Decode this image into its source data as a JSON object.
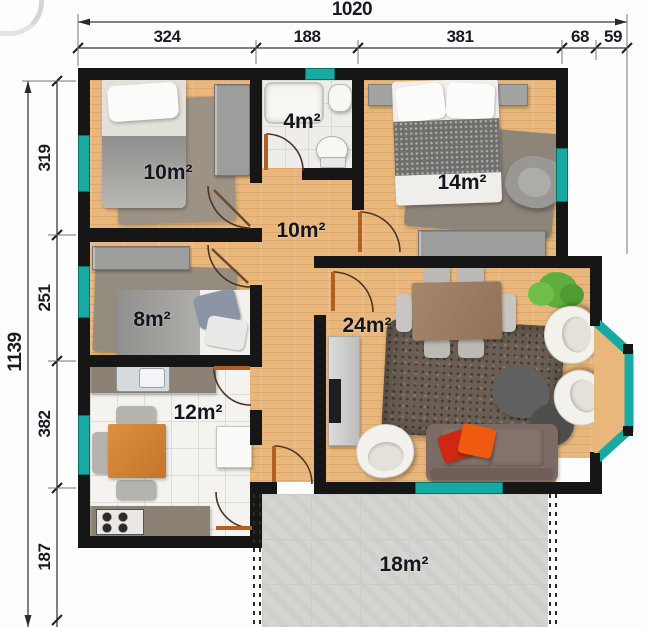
{
  "plan_title": "apartment-floor-plan",
  "dimensions": {
    "top": {
      "total": "1020",
      "segments": [
        "324",
        "188",
        "381",
        "68",
        "59"
      ]
    },
    "left": {
      "total": "1139",
      "segments": [
        "319",
        "251",
        "382",
        "187"
      ]
    }
  },
  "rooms": {
    "bedroom1": {
      "area": "10m²"
    },
    "bathroom": {
      "area": "4m²"
    },
    "bedroom2": {
      "area": "14m²"
    },
    "hall": {
      "area": "10m²"
    },
    "bedroom3": {
      "area": "8m²"
    },
    "living": {
      "area": "24m²"
    },
    "kitchen": {
      "area": "12m²"
    },
    "patio": {
      "area": "18m²"
    }
  },
  "colors": {
    "wall": "#161616",
    "window_teal": "#18a9a2",
    "wood_floor": "#e9b77c",
    "door_leaf": "#b06020",
    "patio_tile": "#d4d4d0",
    "label_text": "#15151f"
  }
}
